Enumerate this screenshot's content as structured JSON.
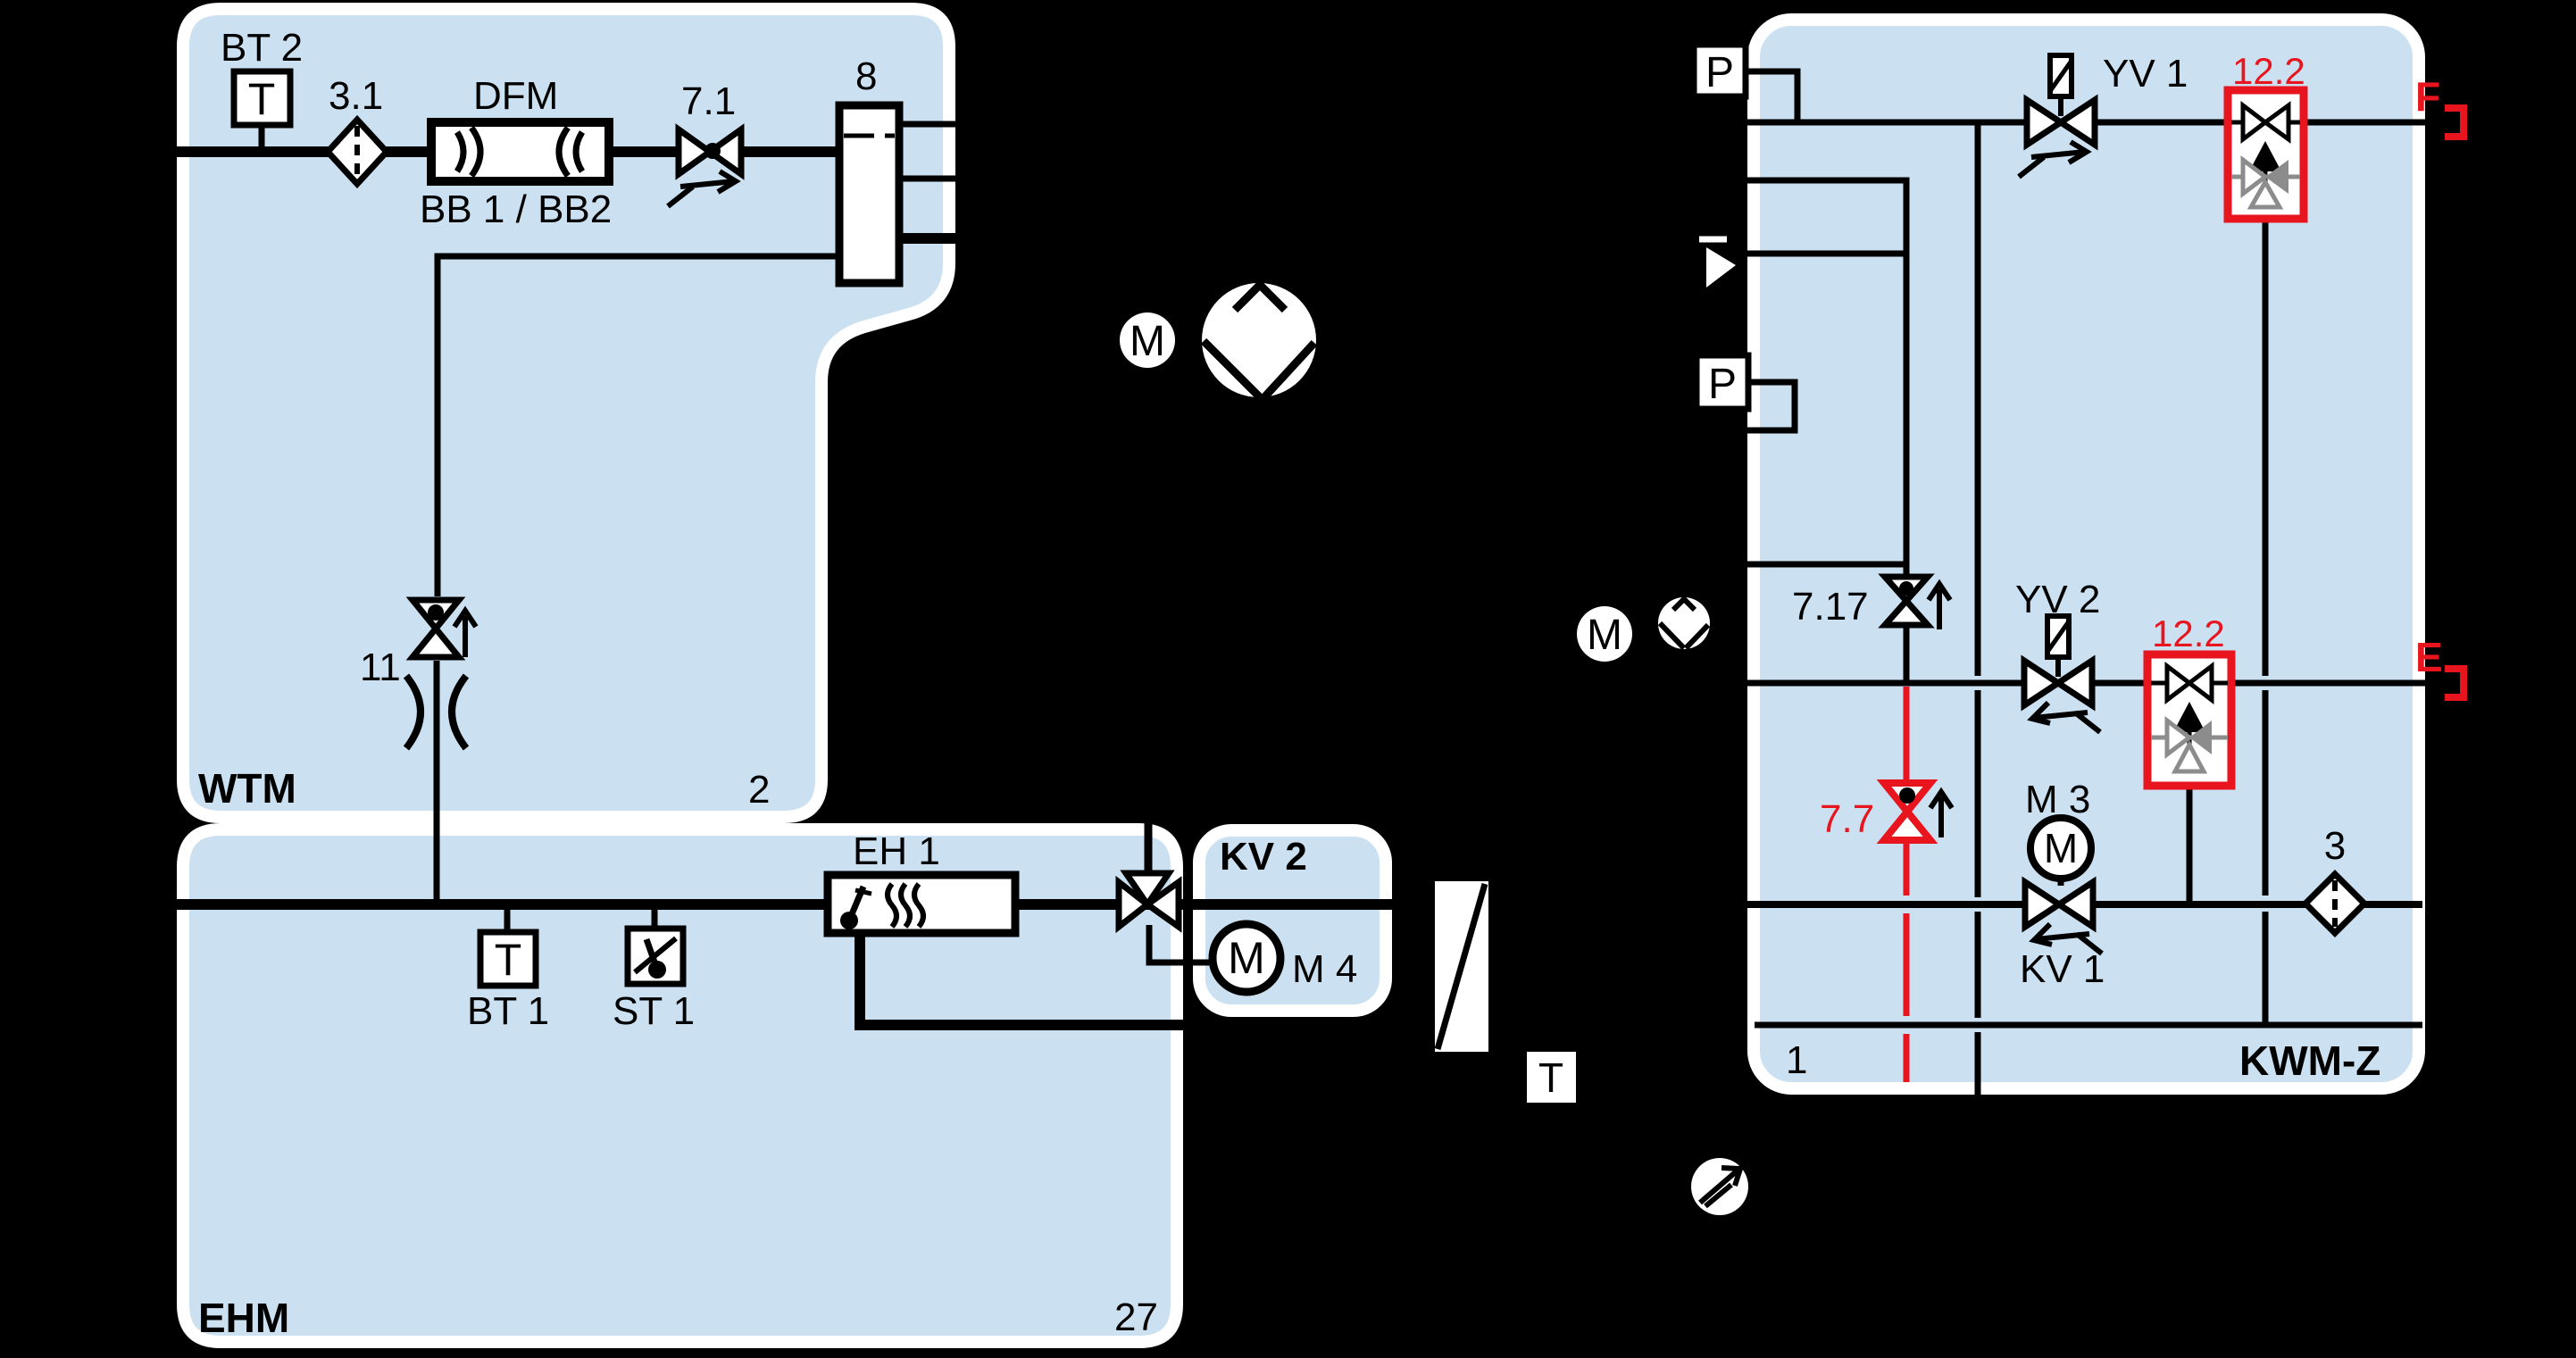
{
  "colors": {
    "background": "#000000",
    "module_fill": "#cbe1f1",
    "module_border": "#ffffff",
    "line": "#000000",
    "alert_red": "#e8141e",
    "inactive_gray": "#8c8c8c"
  },
  "wtm": {
    "name": "WTM",
    "page_number": "2",
    "bt2_label": "BT 2",
    "bt2_symbol": "T",
    "filter_label": "3.1",
    "flowmeter_label": "DFM",
    "flowmeter_sublabel": "BB 1 / BB2",
    "valve71_label": "7.1",
    "tank_label": "8",
    "valve11_label": "11"
  },
  "ehm": {
    "name": "EHM",
    "page_number": "27",
    "bt1_label": "BT 1",
    "bt1_symbol": "T",
    "st1_label": "ST 1",
    "heater_label": "EH 1"
  },
  "kv2": {
    "name": "KV 2",
    "motor_label": "M 4",
    "motor_symbol": "M"
  },
  "kwmz": {
    "name": "KWM-Z",
    "page_number": "1",
    "p_top_label": "P",
    "p_mid_label": "P",
    "yv1_label": "YV 1",
    "yv2_label": "YV 2",
    "check_top_label": "12.2",
    "check_bottom_label": "12.2",
    "valve717_label": "7.17",
    "valve77_label": "7.7",
    "m3_label": "M 3",
    "m3_symbol": "M",
    "kv1_label": "KV 1",
    "filter_label": "3",
    "conn_f_label": "F",
    "conn_e_label": "E"
  },
  "external": {
    "pump_motor_symbol": "M",
    "eline_motor_symbol": "M",
    "hx_sensor_symbol": "T"
  }
}
